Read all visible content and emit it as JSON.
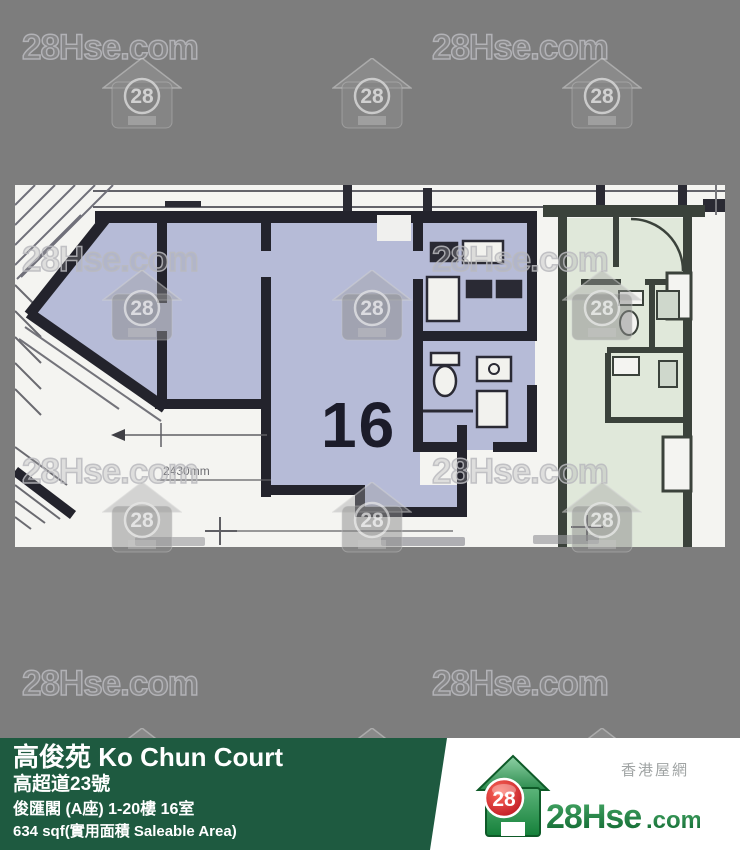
{
  "watermark": {
    "brand": "28Hse.com",
    "badge": "28"
  },
  "plan": {
    "unit_number": "16",
    "dimension_label": "2430mm"
  },
  "footer": {
    "building": "高俊苑 Ko Chun Court",
    "address": "高超道23號",
    "unit": "俊匯閣 (A座) 1-20樓 16室",
    "area": "634 sqf(實用面積 Saleable Area)"
  },
  "logo": {
    "tagline": "香港屋網",
    "name": "28Hse",
    "tld": ".com",
    "badge": "28"
  },
  "colors": {
    "page_bg": "#7d7d7d",
    "bar_green": "#1e5a40",
    "unit_fill": "#b6bbd7",
    "adjacent_fill": "#e0e8da",
    "wall": "#23232c",
    "logo_green": "#1e7d3f",
    "logo_red": "#cf1724"
  }
}
